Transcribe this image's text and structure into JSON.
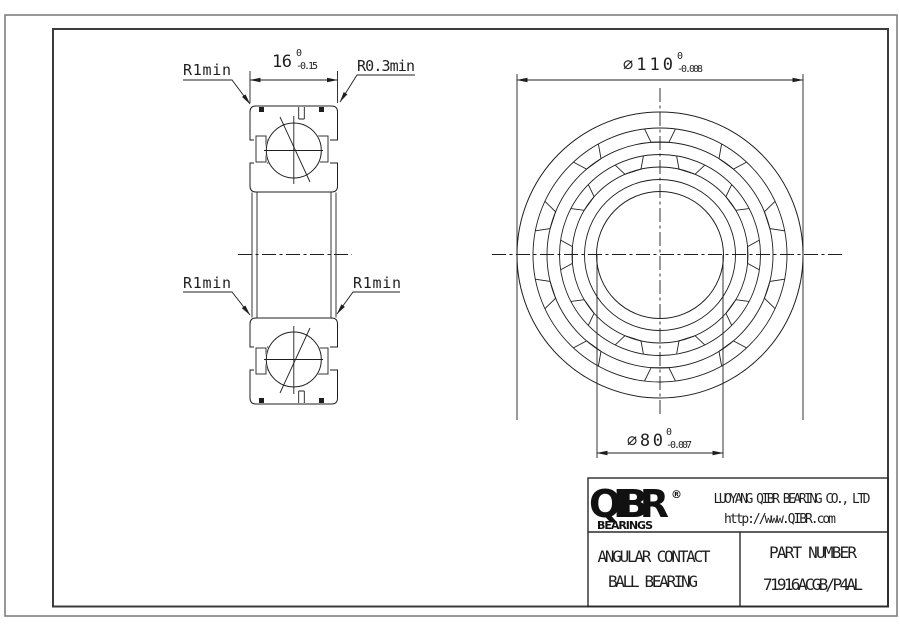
{
  "drawing": {
    "labels": {
      "r1min_top_left": "R1min",
      "r03min_top_right": "R0.3min",
      "r1min_mid_left": "R1min",
      "r1min_mid_right": "R1min"
    },
    "dims": {
      "width_main": "16",
      "width_tol_upper": "0",
      "width_tol_lower": "-0.15",
      "od_main": "∅110",
      "od_tol_upper": "0",
      "od_tol_lower": "-0.008",
      "bore_main": "∅80",
      "bore_tol_upper": "0",
      "bore_tol_lower": "-0.007"
    }
  },
  "title_block": {
    "logo_text": "QIBR",
    "logo_registered": "®",
    "logo_subtitle": "BEARINGS",
    "company_name": "LUOYANG QIBR BEARING CO., LTD",
    "website": "http://www.QIBR.com",
    "product_line1": "ANGULAR CONTACT",
    "product_line2": "BALL BEARING",
    "part_number_label": "PART NUMBER",
    "part_number_value": "71916ACGB/P4AL"
  }
}
